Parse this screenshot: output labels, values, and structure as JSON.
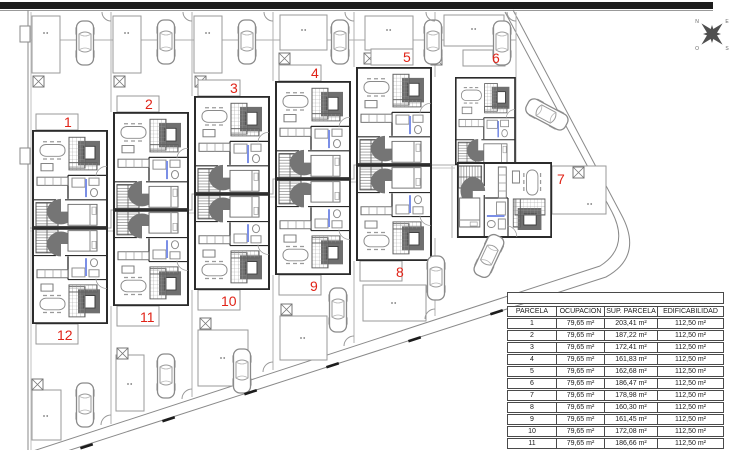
{
  "plan": {
    "parcel_labels": [
      "1",
      "2",
      "3",
      "4",
      "5",
      "6",
      "7",
      "8",
      "9",
      "10",
      "11",
      "12"
    ],
    "compass_letters": [
      "N",
      "E",
      "S",
      "O"
    ],
    "colors": {
      "parcel_number": "#e02317",
      "road_bar": "#1c1c1c",
      "wall": "#2b2b2b",
      "door_mark_blue": "#7b8fe6"
    }
  },
  "table": {
    "headers": [
      "PARCELA",
      "OCUPACION",
      "SUP. PARCELA",
      "EDIFICABILIDAD"
    ],
    "rows": [
      [
        "1",
        "79,65 m²",
        "203,41 m²",
        "112,50 m²"
      ],
      [
        "2",
        "79,65 m²",
        "187,22 m²",
        "112,50 m²"
      ],
      [
        "3",
        "79,65 m²",
        "172,41 m²",
        "112,50 m²"
      ],
      [
        "4",
        "79,65 m²",
        "161,83 m²",
        "112,50 m²"
      ],
      [
        "5",
        "79,65 m²",
        "162,68 m²",
        "112,50 m²"
      ],
      [
        "6",
        "79,65 m²",
        "186,47 m²",
        "112,50 m²"
      ],
      [
        "7",
        "79,65 m²",
        "178,98 m²",
        "112,50 m²"
      ],
      [
        "8",
        "79,65 m²",
        "160,30 m²",
        "112,50 m²"
      ],
      [
        "9",
        "79,65 m²",
        "161,45 m²",
        "112,50 m²"
      ],
      [
        "10",
        "79,65 m²",
        "172,08 m²",
        "112,50 m²"
      ],
      [
        "11",
        "79,65 m²",
        "186,66 m²",
        "112,50 m²"
      ]
    ]
  }
}
